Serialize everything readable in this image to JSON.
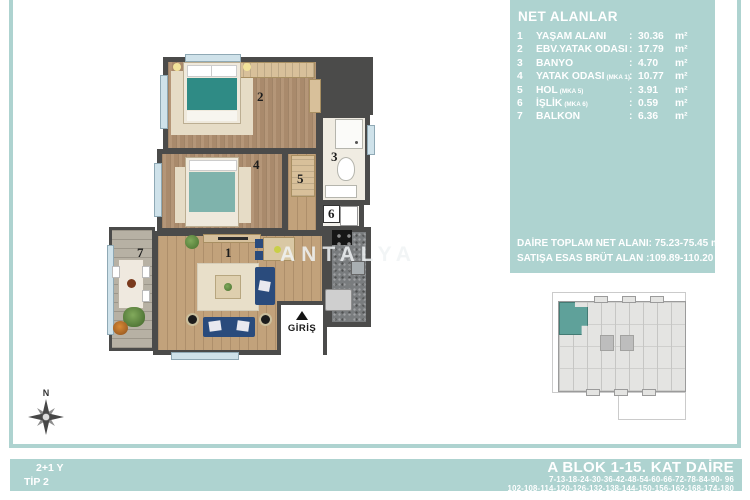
{
  "colors": {
    "panel_teal": "#aed3d0",
    "highlight_teal": "#5fa19a",
    "wall_dark": "#4b4b4a"
  },
  "info_panel": {
    "title": "NET ALANLAR",
    "separator": ":",
    "unit": "m²",
    "rows": [
      {
        "num": "1",
        "label": "YAŞAM ALANI",
        "sub": "",
        "value": "30.36"
      },
      {
        "num": "2",
        "label": "EBV.YATAK ODASI",
        "sub": "",
        "value": "17.79"
      },
      {
        "num": "3",
        "label": "BANYO",
        "sub": "",
        "value": "4.70"
      },
      {
        "num": "4",
        "label": "YATAK ODASI",
        "sub": "(MKA 1)",
        "value": "10.77"
      },
      {
        "num": "5",
        "label": "HOL",
        "sub": "(MKA 5)",
        "value": "3.91"
      },
      {
        "num": "6",
        "label": "İŞLİK",
        "sub": "(MKA 6)",
        "value": "0.59"
      },
      {
        "num": "7",
        "label": "BALKON",
        "sub": "",
        "value": "6.36"
      }
    ],
    "total_net_label": "DAİRE TOPLAM NET ALANI:",
    "total_net_value": "75.23-75.45 m²",
    "gross_label": "SATIŞA ESAS BRÜT ALAN :",
    "gross_value": "109.89-110.20 m²"
  },
  "plan": {
    "room_labels": [
      "1",
      "2",
      "3",
      "4",
      "5",
      "6",
      "7"
    ],
    "entrance_label": "GİRİŞ",
    "watermark": "ANTALYA",
    "compass_label": "N"
  },
  "footer": {
    "type_line1": "2+1 Y",
    "type_line2": "TİP 2",
    "block_title": "A BLOK 1-15. KAT DAİRE",
    "units_line1": "7-13-18-24-30-36-42-48-54-60-66-72-78-84-90- 96",
    "units_line2": "102-108-114-120-126-132-138-144-150-156-162-168-174-180"
  }
}
